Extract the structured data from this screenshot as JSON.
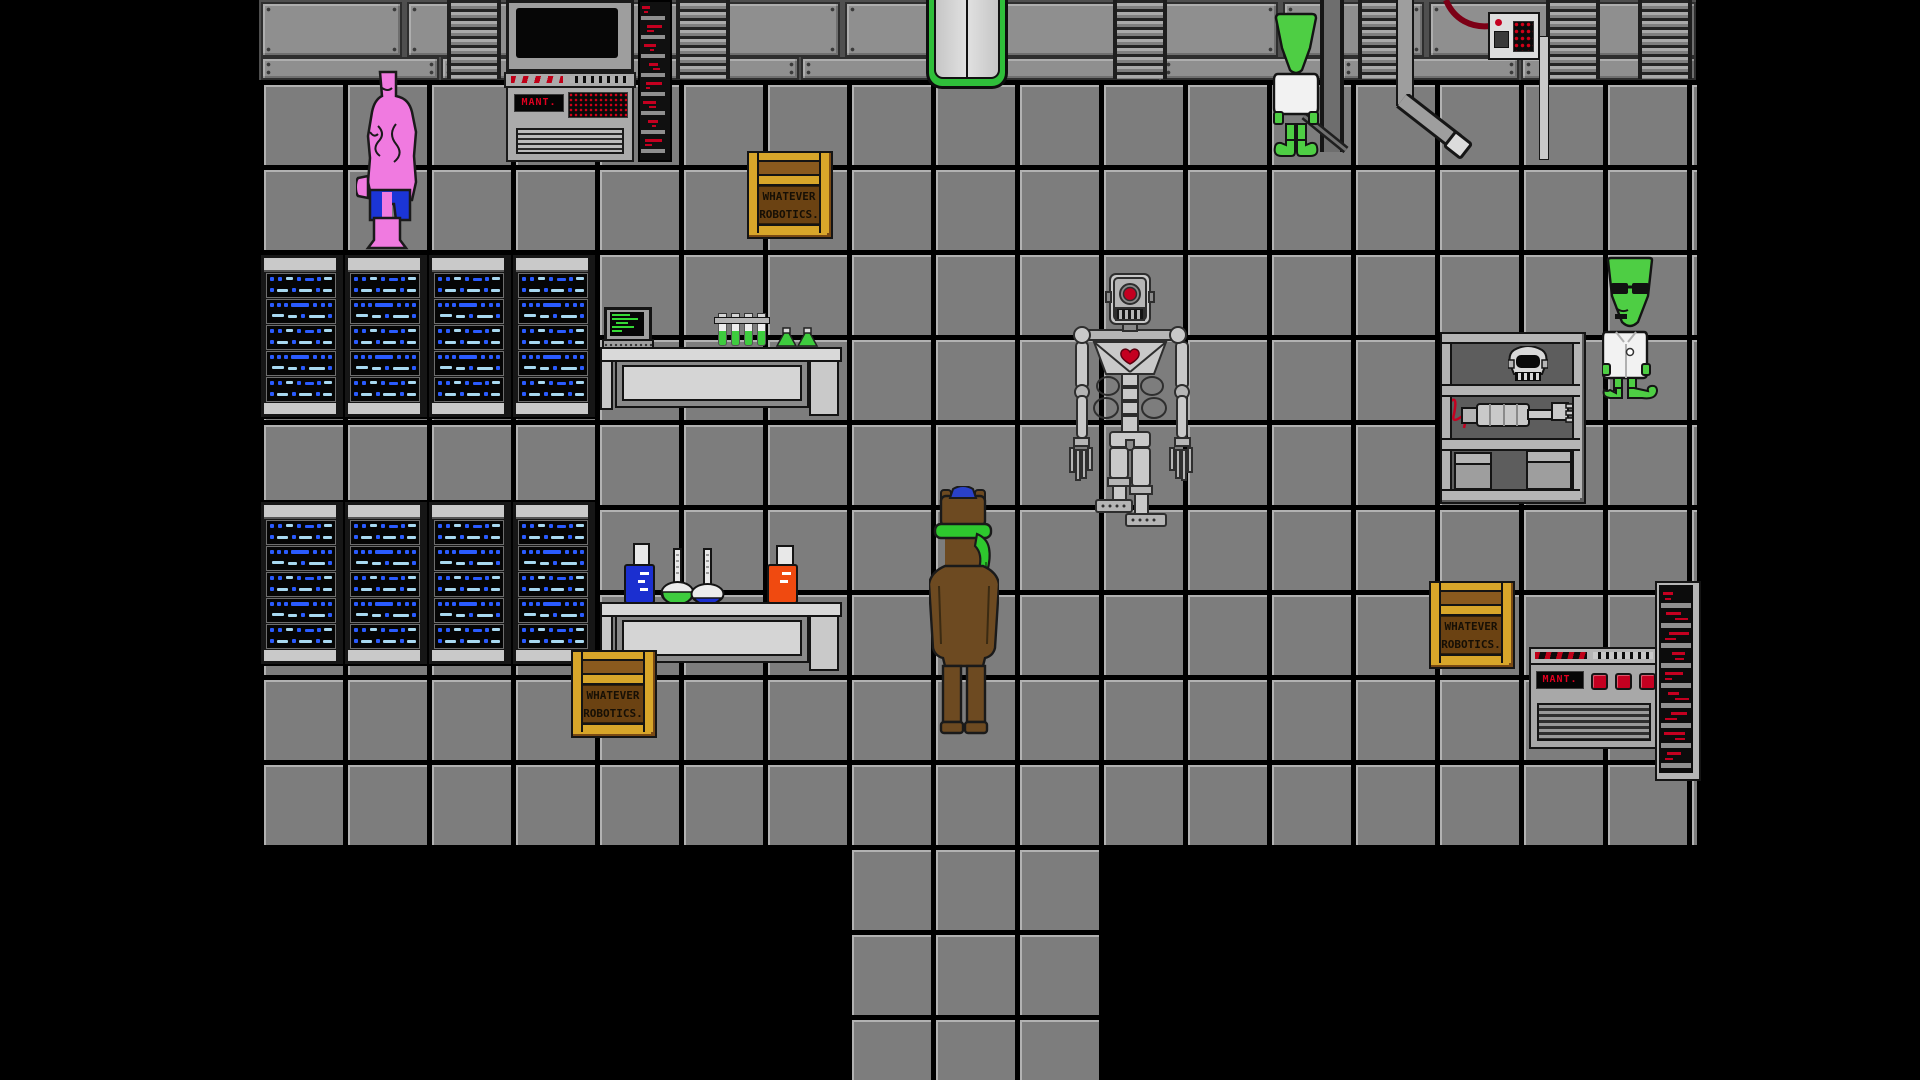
{
  "scene": {
    "name": "Whatever Robotics Laboratory",
    "view": "top-down pixel RPG room",
    "background_color": "#000000"
  },
  "labels": {
    "crate_line1": "WHATEVER",
    "crate_line2": "ROBOTICS.",
    "maint": "MANT."
  },
  "palette": {
    "floor_tile": "#7d7d7d",
    "floor_highlight": "#b2b2b2",
    "wall_panel": "#8f8f8f",
    "wall_gap": "#4f4f4f",
    "outline": "#141414",
    "rack_body": "#c9c9c9",
    "led_blue": "#2a5bff",
    "led_light_blue": "#a8d8f0",
    "led_red": "#c40020",
    "door_green": "#2fbf3a",
    "crate_gold": "#d8a62a",
    "crate_brown": "#7a4a14",
    "alien_green": "#4ece44",
    "muscle_pink": "#f07ae0",
    "shorts_blue": "#1b35d6",
    "horse_brown": "#6d4a21",
    "cap_blue": "#2a41c8",
    "scarf_green": "#2ec82e",
    "robot_gray": "#c9c9c9",
    "robot_eye_red": "#c40020",
    "flask_green": "#3ecc3e",
    "flask_blue": "#1b2fd0",
    "flask_orange": "#f04a10",
    "screen_text_green": "#35d935"
  },
  "characters": [
    {
      "id": "muscle-creature",
      "label": "pink muscle creature with blue shorts"
    },
    {
      "id": "alien-worker",
      "label": "green alien in white shirt facing wall"
    },
    {
      "id": "skeletal-robot",
      "label": "gray one-eyed skeletal robot with red core"
    },
    {
      "id": "horse-player",
      "label": "brown horse character with blue cap and green scarf"
    },
    {
      "id": "alien-scientist",
      "label": "green alien scientist with glasses and lab coat"
    }
  ],
  "objects": [
    {
      "id": "maint-terminal-top",
      "label": "maintenance terminal with monitor"
    },
    {
      "id": "maint-console-bottom",
      "label": "maintenance console with three red buttons"
    },
    {
      "id": "server-racks",
      "label": "blue blinking server racks",
      "count": 8
    },
    {
      "id": "red-led-racks",
      "label": "red LED equipment columns",
      "count": 2
    },
    {
      "id": "lab-tables",
      "label": "lab tables with glassware",
      "count": 2
    },
    {
      "id": "supply-crates",
      "label": "Whatever Robotics supply crates",
      "count": 3
    },
    {
      "id": "parts-shelf",
      "label": "shelf with robot skull and disassembled body"
    },
    {
      "id": "exit-door",
      "label": "green-framed north door"
    },
    {
      "id": "wall-control-box",
      "label": "wall control box with cable and pipes"
    }
  ]
}
